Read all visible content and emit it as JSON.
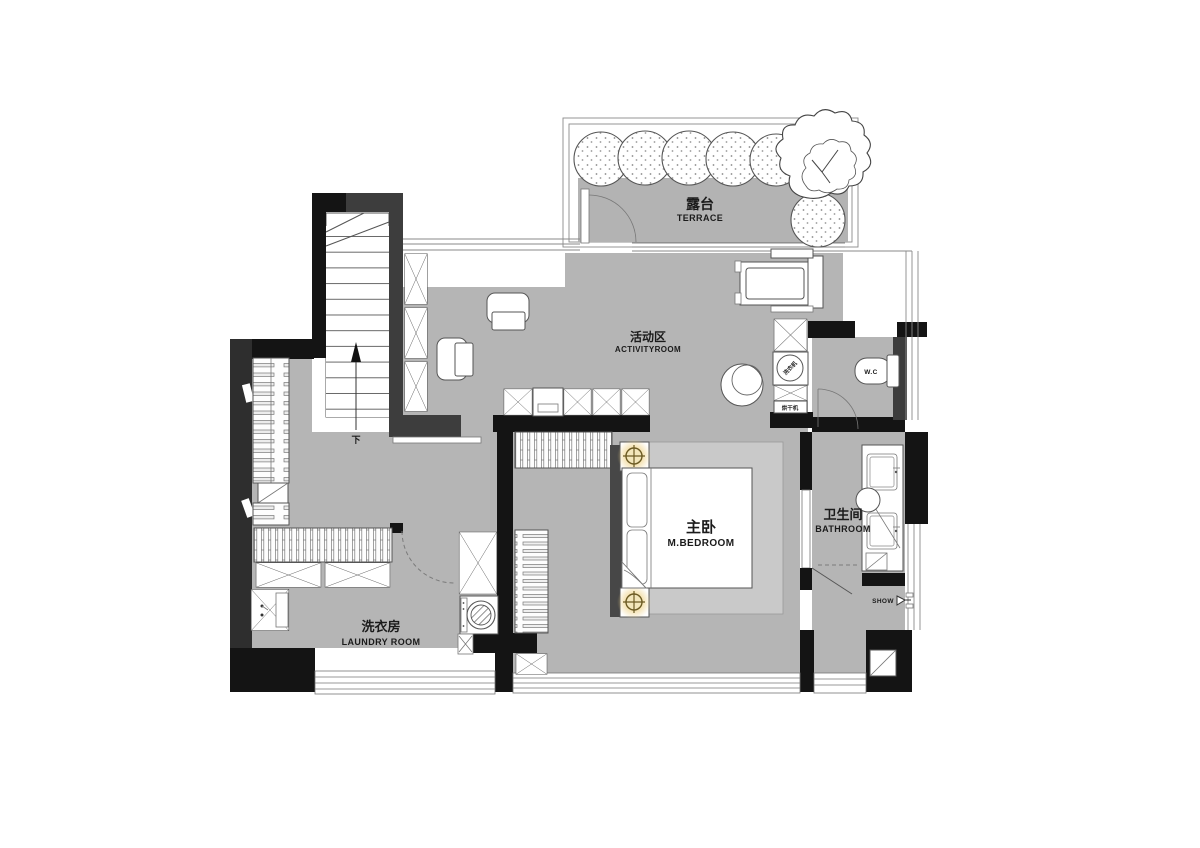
{
  "rooms": [
    {
      "id": "terrace",
      "name_cn": "露台",
      "name_en": "TERRACE"
    },
    {
      "id": "activity_room",
      "name_cn": "活动区",
      "name_en": "ACTIVITYROOM"
    },
    {
      "id": "master_bedroom",
      "name_cn": "主卧",
      "name_en": "M.BEDROOM"
    },
    {
      "id": "bathroom",
      "name_cn": "卫生间",
      "name_en": "BATHROOM"
    },
    {
      "id": "laundry_room",
      "name_cn": "洗衣房",
      "name_en": "LAUNDRY ROOM"
    }
  ],
  "fixtures": {
    "toilet_label": "W.C",
    "shower_label": "SHOW",
    "stair_direction_label": "下",
    "washer_circle_label": "洗衣机",
    "dryer_label": "烘干机"
  },
  "icons": {
    "tree": "stippled-circle-tree",
    "big_tree": "organic-foliage-tree",
    "bed_lamp": "crosshair-circle-lamp",
    "washing_machine": "hatched-drum",
    "shower": "shower-head",
    "stair_arrow": "up-arrow"
  },
  "colors": {
    "floor_gray": "#b5b5b5",
    "wall_black": "#141414",
    "wall_gray": "#3d3d3d",
    "rug_gray": "#c9c9c9",
    "lamp_glow": "#edc05a",
    "background": "#ffffff"
  }
}
